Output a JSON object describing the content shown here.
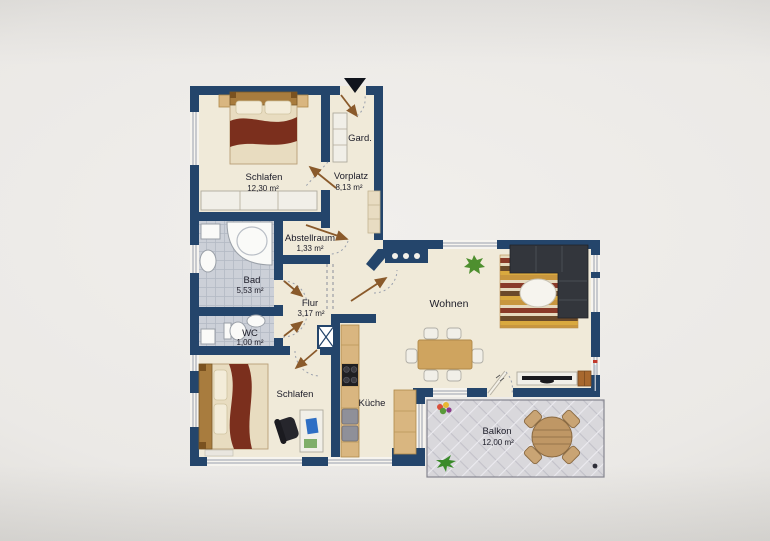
{
  "rooms": {
    "schlafen1": {
      "name": "Schlafen",
      "area": "12,30 m²"
    },
    "gard": {
      "name": "Gard."
    },
    "vorplatz": {
      "name": "Vorplatz",
      "area": "8,13 m²"
    },
    "abstellraum": {
      "name": "Abstellraum",
      "area": "1,33 m²"
    },
    "bad": {
      "name": "Bad",
      "area": "5,53 m²"
    },
    "flur": {
      "name": "Flur",
      "area": "3,17 m²"
    },
    "wc": {
      "name": "WC",
      "area": "1,00 m²"
    },
    "schlafen2": {
      "name": "Schlafen"
    },
    "kueche": {
      "name": "Küche"
    },
    "wohnen": {
      "name": "Wohnen"
    },
    "balkon": {
      "name": "Balkon",
      "area": "12,00 m²"
    }
  },
  "colors": {
    "wall": "#24456b",
    "floor": "#f0ead9",
    "tile": "#ccd0d8",
    "balcony": "#d9d8dc",
    "wood": "#d9b680",
    "blanket": "#7b2f1d",
    "sofa": "#33363c",
    "door": "#8a5a2b",
    "label": "#1c1c28"
  }
}
